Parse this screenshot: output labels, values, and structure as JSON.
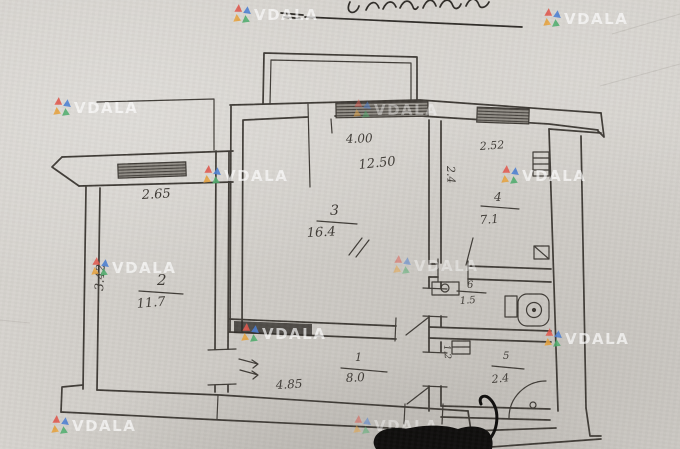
{
  "theme": {
    "paper": "#d6d3ce",
    "ink": "#3e3a35",
    "ink-dark": "#2e2b27",
    "redaction": "#0d0c0b",
    "wm-text": "rgba(255,255,255,0.78)",
    "wm0": "#e2574c",
    "wm1": "#4a7fd4",
    "wm2": "#e8a33d",
    "wm3": "#4fae6d"
  },
  "watermark": {
    "text": "VDALA"
  },
  "plan": {
    "rooms": [
      {
        "number": "1",
        "area": "8.0"
      },
      {
        "number": "2",
        "area": "11.7"
      },
      {
        "number": "3",
        "area": "16.4"
      },
      {
        "number": "4",
        "area": "7.1"
      },
      {
        "number": "5",
        "area": "2.4"
      },
      {
        "number": "6",
        "area": "1.5"
      }
    ],
    "dimensions": {
      "room2_width": "2.65",
      "room2_depth": "3.42",
      "room3_width": "4.00",
      "room3_length": "12.50",
      "room4_width": "2.52",
      "room4_depth": "2.4",
      "bath_width": "1.2",
      "corridor_length": "4.85"
    }
  }
}
